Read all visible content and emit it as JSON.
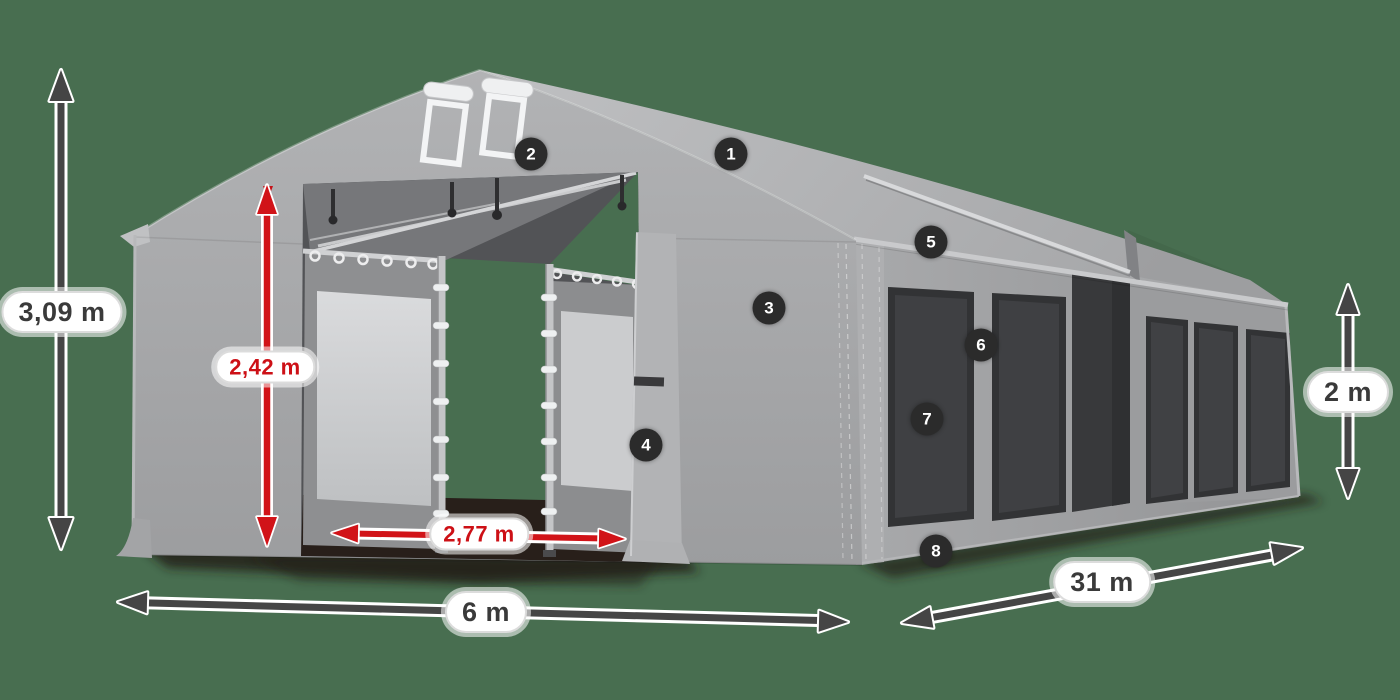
{
  "scene": {
    "background_color": "#486E50",
    "tent_gray": "#a5a6a8",
    "accent_red": "#d11318",
    "arrow_color": "#454545",
    "badge_color": "#2b2b2b",
    "label_text_color": "#3a3a3a"
  },
  "dimension_labels": {
    "total_height": "3,09 m",
    "inner_height": "2,42 m",
    "door_width": "2,77 m",
    "width": "6 m",
    "length": "31 m",
    "side_wall_height": "2 m"
  },
  "feature_badges": [
    {
      "number": "1"
    },
    {
      "number": "2"
    },
    {
      "number": "3"
    },
    {
      "number": "4"
    },
    {
      "number": "5"
    },
    {
      "number": "6"
    },
    {
      "number": "7"
    },
    {
      "number": "8"
    }
  ]
}
